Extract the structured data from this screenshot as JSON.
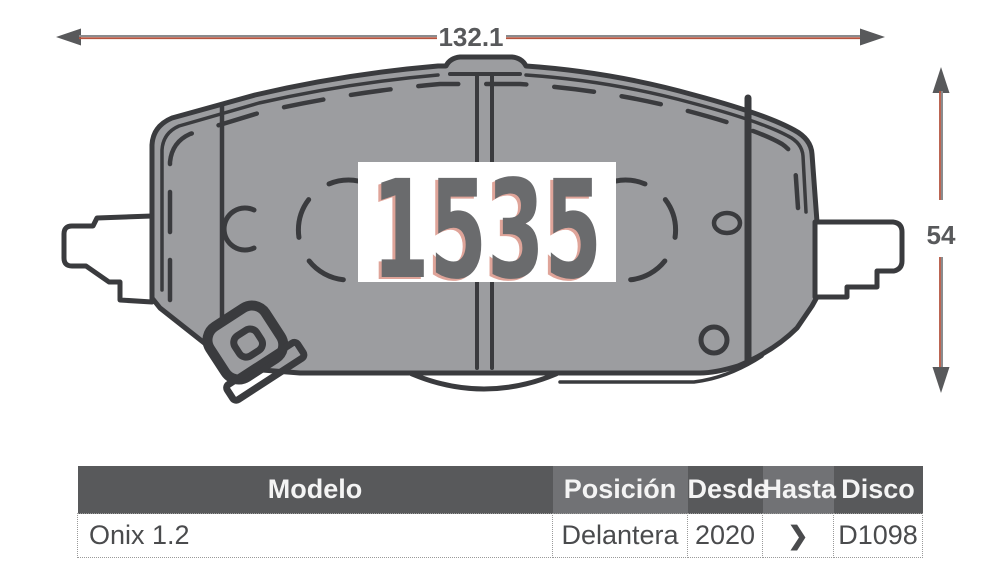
{
  "part_number": "1535",
  "dimensions": {
    "width": "132.1",
    "height": "54"
  },
  "table": {
    "headers": [
      "Modelo",
      "Posición",
      "Desde",
      "Hasta",
      "Disco"
    ],
    "rows": [
      {
        "modelo": "Onix 1.2",
        "posicion": "Delantera",
        "desde": "2020",
        "hasta": "❯",
        "disco": "D1098"
      }
    ]
  },
  "colors": {
    "header_dark": "#58595b",
    "header_light": "#717275",
    "dimension_gray": "#58595b",
    "dimension_gray_line": "#8a8b8d",
    "dimension_red": "#b5543f",
    "pad_fill": "#9c9da0",
    "outline": "#3a3b3e",
    "part_number_gray": "#6a6b6d",
    "part_number_red_shadow": "#c14b35"
  }
}
